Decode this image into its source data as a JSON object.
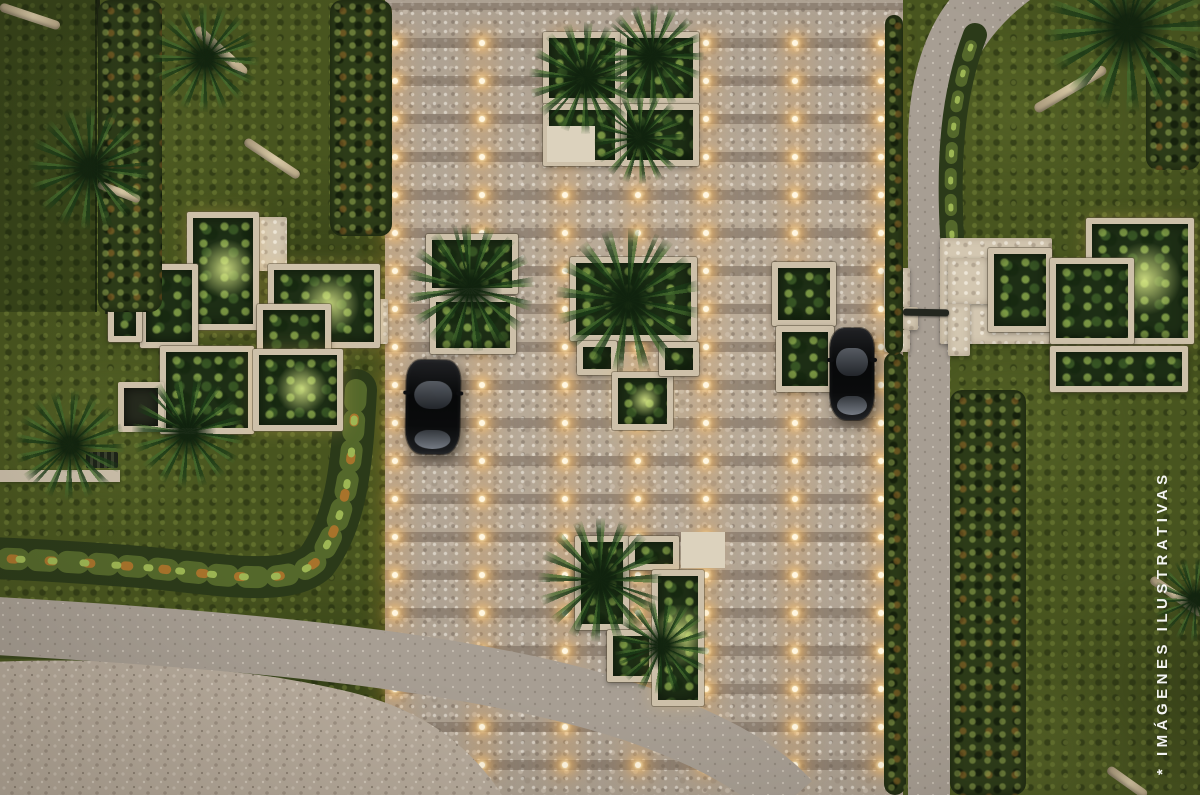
{
  "watermark": {
    "text": "* IMÁGENES ILUSTRATIVAS"
  },
  "palette": {
    "stone": "#b5a99a",
    "stone_band": "#766858",
    "motor_court": "#b7ab9c",
    "road": "#a79e93",
    "lane": "#a79e93",
    "lawn": "#48551f",
    "lawn_sliver": "#39461c",
    "shrub_dark": "#2b3a19",
    "shrub_mid": "#54682b",
    "shrub_accent": "#a8732b",
    "shrub_light": "#9db654",
    "fence": "#1b2310",
    "planter_stone": "#cdc0a9",
    "light_core": "#fff6e0",
    "light_glow": "#ffc878",
    "car_body": "#0a0b0c"
  },
  "scene": {
    "lights": {
      "cols": [
        395,
        482,
        565,
        638,
        706,
        795,
        881
      ],
      "row_start": 43,
      "row_step": 38,
      "row_count": 20
    },
    "planters": [
      [
        187,
        212,
        72,
        118,
        "accent"
      ],
      [
        140,
        264,
        58,
        84,
        ""
      ],
      [
        108,
        276,
        34,
        66,
        ""
      ],
      [
        268,
        264,
        112,
        84,
        "accent"
      ],
      [
        257,
        304,
        74,
        84,
        ""
      ],
      [
        160,
        346,
        94,
        88,
        ""
      ],
      [
        253,
        349,
        90,
        82,
        "accent"
      ],
      [
        118,
        382,
        46,
        50,
        "empty"
      ],
      [
        426,
        234,
        92,
        60,
        ""
      ],
      [
        430,
        296,
        86,
        58,
        ""
      ],
      [
        543,
        32,
        78,
        72,
        ""
      ],
      [
        621,
        32,
        78,
        72,
        ""
      ],
      [
        543,
        104,
        78,
        62,
        ""
      ],
      [
        621,
        104,
        78,
        62,
        ""
      ],
      [
        570,
        257,
        127,
        84,
        ""
      ],
      [
        577,
        341,
        40,
        34,
        ""
      ],
      [
        612,
        372,
        61,
        58,
        "accent"
      ],
      [
        659,
        342,
        40,
        34,
        ""
      ],
      [
        772,
        262,
        64,
        64,
        ""
      ],
      [
        776,
        326,
        58,
        66,
        ""
      ],
      [
        575,
        536,
        54,
        94,
        ""
      ],
      [
        629,
        536,
        50,
        34,
        ""
      ],
      [
        607,
        630,
        48,
        52,
        ""
      ],
      [
        652,
        570,
        52,
        136,
        "accent"
      ],
      [
        988,
        248,
        64,
        84,
        ""
      ],
      [
        1086,
        218,
        108,
        126,
        "accent"
      ],
      [
        1050,
        258,
        84,
        86,
        ""
      ],
      [
        1050,
        346,
        138,
        46,
        ""
      ]
    ],
    "walls": [
      [
        940,
        238,
        112,
        106
      ],
      [
        948,
        258,
        60,
        46
      ],
      [
        948,
        304,
        22,
        52
      ],
      [
        257,
        217,
        30,
        54
      ],
      [
        343,
        299,
        45,
        45
      ]
    ],
    "pads": [
      [
        547,
        126,
        48,
        36
      ],
      [
        681,
        532,
        44,
        36
      ]
    ],
    "pillars": [
      [
        884,
        268,
        26,
        39
      ],
      [
        903,
        307,
        15,
        23
      ],
      [
        884,
        330,
        26,
        22
      ]
    ],
    "bushes": [
      [
        98,
        0,
        64,
        312
      ],
      [
        330,
        0,
        62,
        236
      ],
      [
        884,
        352,
        22,
        443
      ],
      [
        950,
        390,
        76,
        405
      ],
      [
        885,
        15,
        18,
        340
      ],
      [
        1146,
        48,
        54,
        122
      ]
    ],
    "fronds": [
      [
        90,
        168,
        62
      ],
      [
        205,
        58,
        54
      ],
      [
        188,
        432,
        56
      ],
      [
        70,
        445,
        55
      ],
      [
        470,
        288,
        64
      ],
      [
        585,
        78,
        56
      ],
      [
        652,
        56,
        52
      ],
      [
        640,
        138,
        46
      ],
      [
        628,
        300,
        72
      ],
      [
        600,
        580,
        62
      ],
      [
        662,
        646,
        48
      ],
      [
        1128,
        28,
        84
      ],
      [
        1195,
        600,
        42
      ]
    ],
    "trunks": [
      [
        196,
        28,
        246,
        74,
        10
      ],
      [
        245,
        140,
        299,
        176,
        9
      ],
      [
        98,
        184,
        140,
        200,
        8
      ],
      [
        0,
        6,
        60,
        26,
        9
      ],
      [
        1035,
        110,
        1106,
        68,
        10
      ],
      [
        1151,
        578,
        1203,
        614,
        9
      ],
      [
        1108,
        768,
        1146,
        795,
        9
      ]
    ],
    "garden_path": [
      0,
      470,
      120,
      12
    ],
    "bench": [
      86,
      452,
      32,
      16
    ],
    "cars": [
      [
        406,
        360,
        54,
        94,
        1
      ],
      [
        830,
        328,
        44,
        92,
        0
      ]
    ],
    "barrier": [
      903,
      309,
      46,
      7
    ],
    "court": [
      0,
      0,
      97,
      312
    ]
  }
}
